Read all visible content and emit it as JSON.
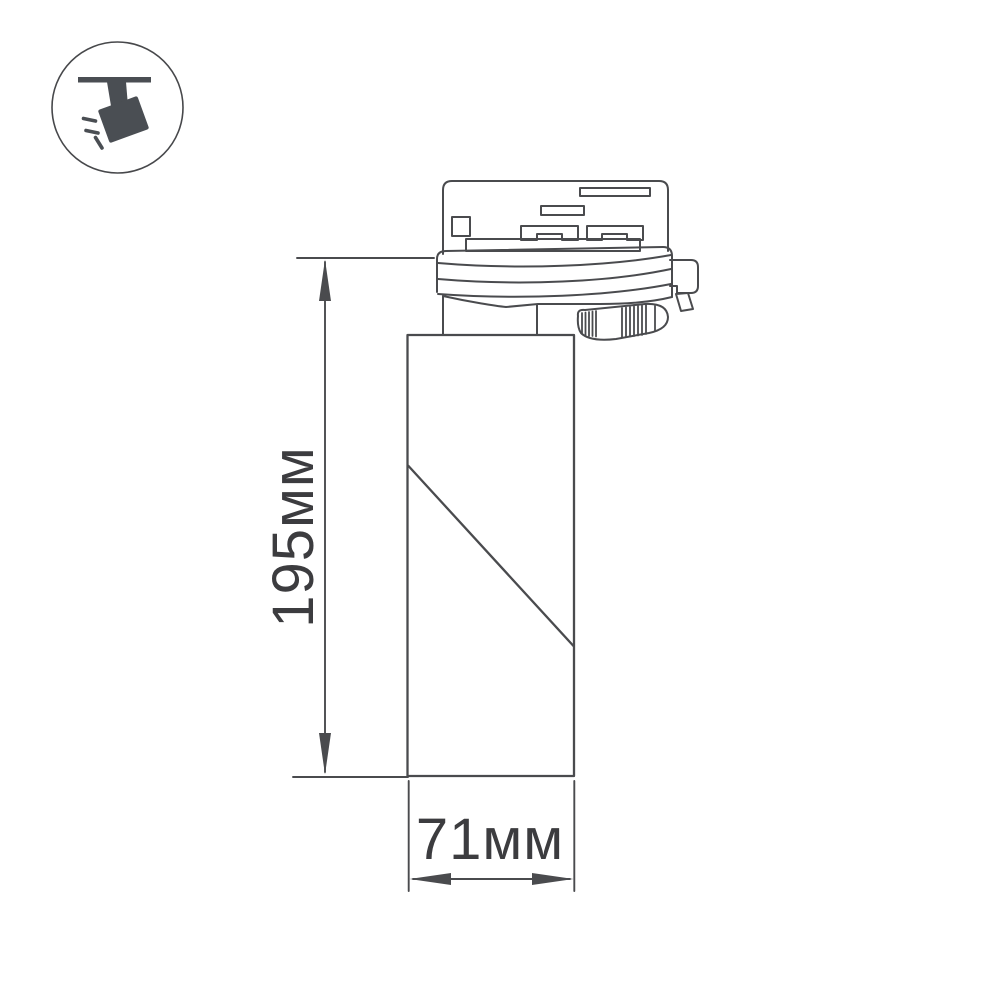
{
  "page": {
    "background": "#ffffff"
  },
  "icon_badge": {
    "icon": "ceiling-track-spotlight-icon",
    "fill": "#4a4e53",
    "circle_color": "#47484b"
  },
  "drawing": {
    "type": "technical-dimension-drawing",
    "line_color": "#4a4b4e",
    "text_color": "#3c3c3f",
    "dimensions": {
      "height_label": "195мм",
      "width_label": "71мм"
    }
  }
}
